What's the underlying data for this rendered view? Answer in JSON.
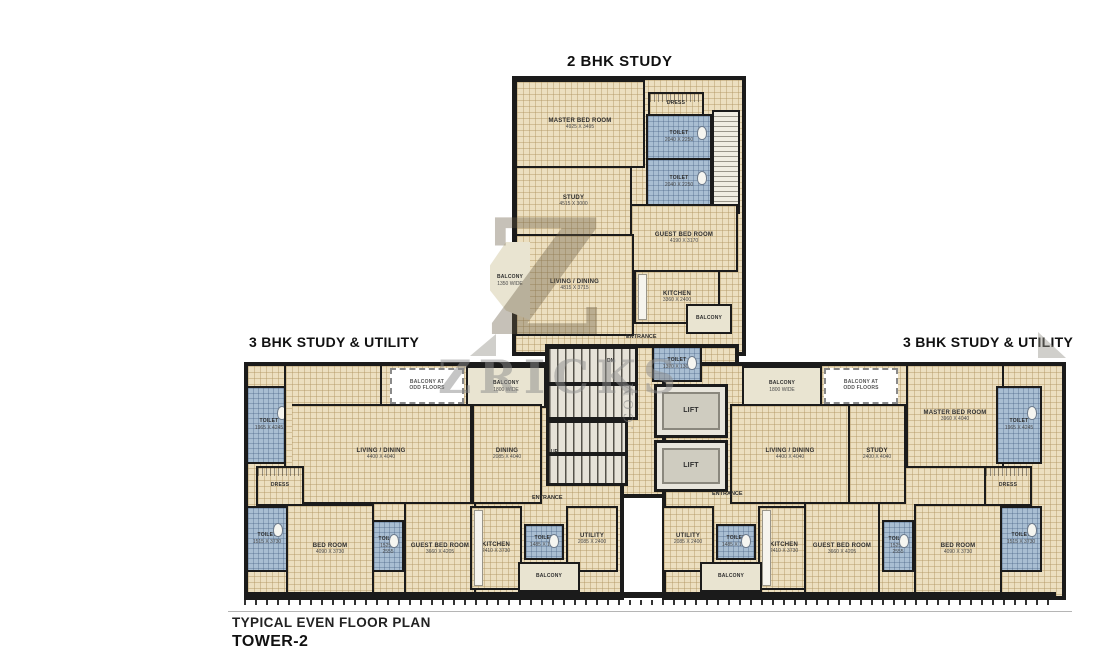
{
  "titles": {
    "bhk2": "2 BHK STUDY",
    "bhk3_left": "3 BHK STUDY & UTILITY",
    "bhk3_right": "3 BHK STUDY & UTILITY"
  },
  "footer": {
    "line1": "TYPICAL EVEN FLOOR PLAN",
    "line2": "TOWER-2"
  },
  "watermark": {
    "big_letter": "Z",
    "text": "ZRICKS",
    "suffix": ".COM"
  },
  "colors": {
    "wall": "#1b1b1b",
    "tile": "#ecdfc0",
    "wet": "#a9bed2",
    "balcony": "#e9e4d1"
  },
  "core": {
    "lift1": "LIFT",
    "lift2": "LIFT",
    "toilet": {
      "label": "TOILET",
      "dim": "1370 X 1300"
    },
    "up": "UP",
    "dn": "DN",
    "entrance_top": "ENTRANCE",
    "entrance_left": "ENTRANCE",
    "entrance_right": "ENTRANCE"
  },
  "unit2bhk": {
    "rooms": {
      "master": {
        "label": "MASTER BED ROOM",
        "dim": "4925 X 3495"
      },
      "dress": {
        "label": "DRESS"
      },
      "toilet_a": {
        "label": "TOILET",
        "dim": "2040 X 2250"
      },
      "toilet_b": {
        "label": "TOILET",
        "dim": "2040 X 2250"
      },
      "study": {
        "label": "STUDY",
        "dim": "4515 X 3000"
      },
      "guest": {
        "label": "GUEST BED ROOM",
        "dim": "4190 X 3170"
      },
      "kitchen": {
        "label": "KITCHEN",
        "dim": "3360 X 2400"
      },
      "living": {
        "label": "LIVING / DINING",
        "dim": "4815 X 3715"
      },
      "balcony_left": {
        "label": "BALCONY",
        "dim": "1350 WIDE"
      },
      "balcony_right": {
        "label": "BALCONY"
      }
    }
  },
  "unit3bhk_left": {
    "rooms": {
      "master": {
        "label": "MASTER BED ROOM",
        "dim": "3960 X 4040"
      },
      "toilet_top": {
        "label": "TOILET",
        "dim": "1965 X 4245"
      },
      "balcony_odd": {
        "label": "BALCONY AT\nODD FLOORS"
      },
      "balcony_1800": {
        "label": "BALCONY",
        "dim": "1800 WIDE"
      },
      "living": {
        "label": "LIVING / DINING",
        "dim": "4400 X 4040"
      },
      "dining": {
        "label": "DINING",
        "dim": "2085 X 4040"
      },
      "dress": {
        "label": "DRESS"
      },
      "toilet_left": {
        "label": "TOILET",
        "dim": "1515 X 3730"
      },
      "bed": {
        "label": "BED ROOM",
        "dim": "4090 X 3730"
      },
      "toilet_mid": {
        "label": "TOILET",
        "dim": "1525 X 2555"
      },
      "guest": {
        "label": "GUEST BED ROOM",
        "dim": "3660 X 4205"
      },
      "kitchen": {
        "label": "KITCHEN",
        "dim": "2410 X 3730"
      },
      "toilet_small": {
        "label": "TOILET",
        "dim": "1485 X 1200"
      },
      "utility": {
        "label": "UTILITY",
        "dim": "2085 X 2400"
      },
      "balcony": {
        "label": "BALCONY"
      }
    }
  },
  "unit3bhk_right": {
    "rooms": {
      "master": {
        "label": "MASTER BED ROOM",
        "dim": "3960 X 4040"
      },
      "toilet_top": {
        "label": "TOILET",
        "dim": "1965 X 4245"
      },
      "balcony_odd": {
        "label": "BALCONY AT\nODD FLOORS"
      },
      "balcony_1800": {
        "label": "BALCONY",
        "dim": "1800 WIDE"
      },
      "living": {
        "label": "LIVING / DINING",
        "dim": "4400 X 4040"
      },
      "study": {
        "label": "STUDY",
        "dim": "2400 X 4040"
      },
      "dress": {
        "label": "DRESS"
      },
      "toilet_right": {
        "label": "TOILET",
        "dim": "1515 X 3730"
      },
      "bed": {
        "label": "BED ROOM",
        "dim": "4090 X 3730"
      },
      "toilet_mid": {
        "label": "TOILET",
        "dim": "1525 X 2555"
      },
      "guest": {
        "label": "GUEST BED ROOM",
        "dim": "3660 X 4205"
      },
      "kitchen": {
        "label": "KITCHEN",
        "dim": "2410 X 3730"
      },
      "toilet_small": {
        "label": "TOILET",
        "dim": "1485 X 1200"
      },
      "utility": {
        "label": "UTILITY",
        "dim": "2085 X 2400"
      },
      "balcony": {
        "label": "BALCONY"
      }
    }
  }
}
